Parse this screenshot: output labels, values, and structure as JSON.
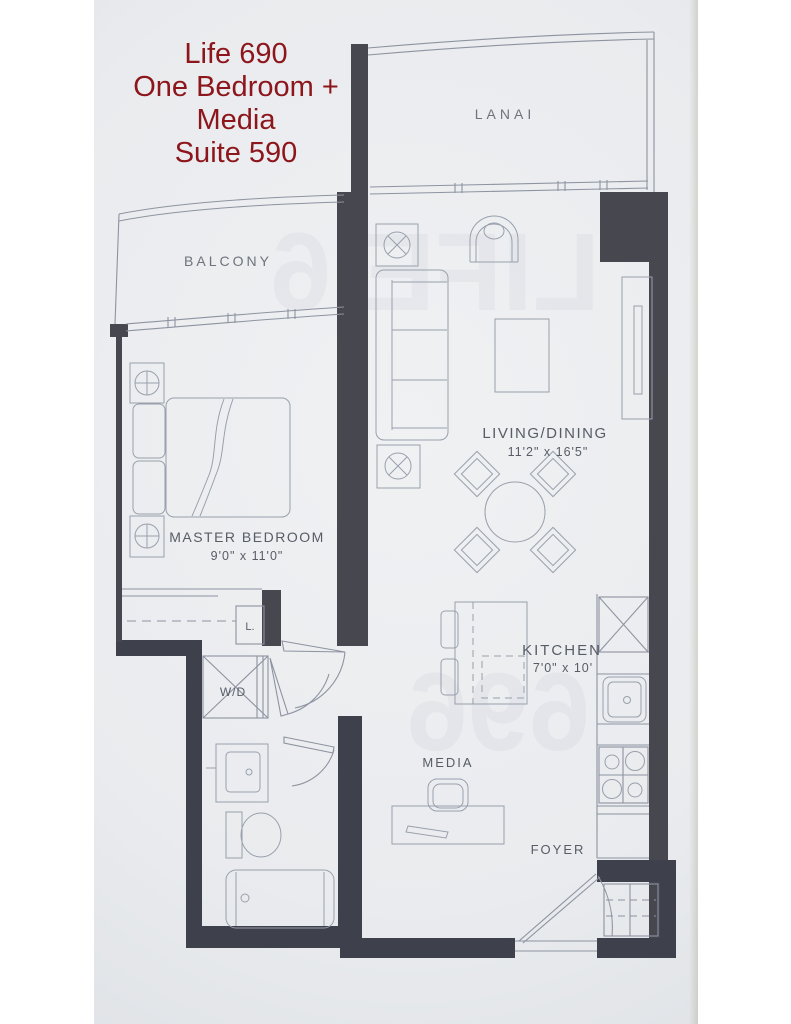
{
  "title": {
    "lines": [
      "Life 690",
      "One Bedroom +",
      "Media",
      "Suite 590"
    ],
    "color": "#8c161b"
  },
  "floorplan": {
    "rooms": {
      "lanai": {
        "label": "LANAI"
      },
      "balcony": {
        "label": "BALCONY"
      },
      "master_bedroom": {
        "label": "MASTER BEDROOM",
        "dims": "9'0\" x 11'0\""
      },
      "living_dining": {
        "label": "LIVING/DINING",
        "dims": "11'2\" x 16'5\""
      },
      "kitchen": {
        "label": "KITCHEN",
        "dims": "7'0\" x 10'"
      },
      "media": {
        "label": "MEDIA"
      },
      "foyer": {
        "label": "FOYER"
      }
    },
    "closets": {
      "laundry_label": "W/D",
      "linen_label": "L."
    },
    "colors": {
      "title_red": "#8c161b",
      "wall": "#46474f",
      "wall_dark": "#3e404c",
      "thin_line": "#8d93a0",
      "room_label": "#575c66",
      "page": "#e9ebee"
    }
  }
}
